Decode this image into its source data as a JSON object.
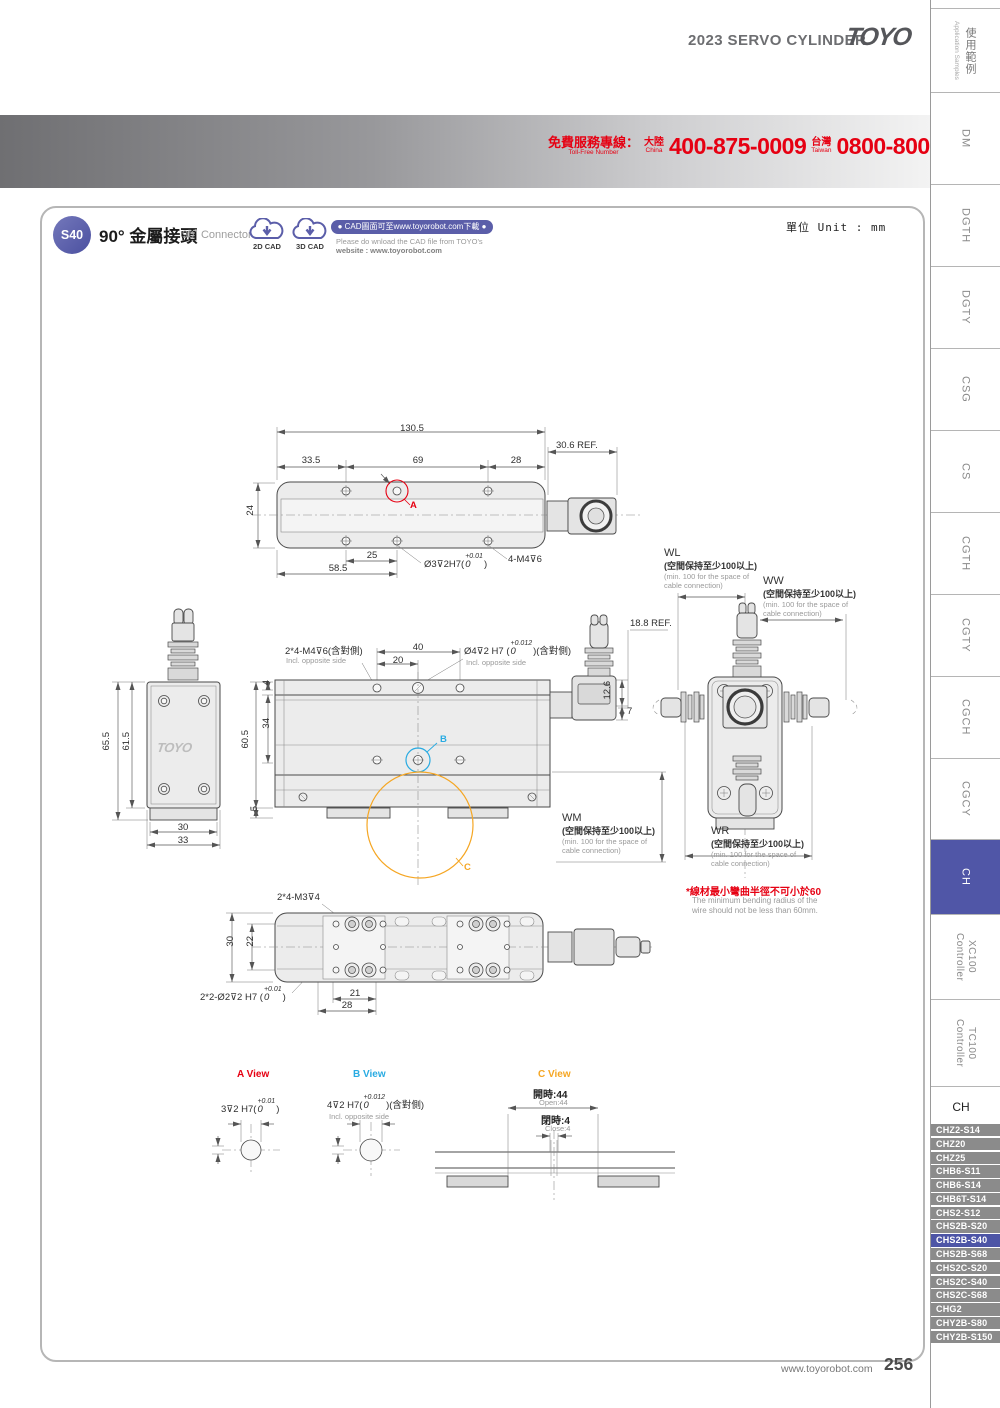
{
  "header": {
    "title": "2023 SERVO CYLINDER",
    "logo": "TOYO"
  },
  "tollfree": {
    "label_zh": "免費服務專線：",
    "label_en": "Toll-Free Number",
    "china_zh": "大陸",
    "china_en": "China",
    "china_number": "400-875-0009",
    "taiwan_zh": "台灣",
    "taiwan_en": "Taiwan",
    "taiwan_number": "0800-800-893"
  },
  "product": {
    "badge": "S40",
    "title_zh": "90° 金屬接頭",
    "title_en": "90˚ Connector",
    "cad_2d": "2D CAD",
    "cad_3d": "3D CAD",
    "cad_pill": "● CAD圖面可至www.toyorobot.com下載 ●",
    "cad_note1": "Please do wnload the CAD file from TOYO's",
    "cad_note2": "website : www.toyorobot.com",
    "unit": "單位 Unit : mm"
  },
  "sidebar": {
    "top_zh": "使用範例",
    "top_en": "Application Samples",
    "tabs": [
      "DM",
      "DGTH",
      "DGTY",
      "CSG",
      "CS",
      "CGTH",
      "CGTY",
      "CGCH",
      "CGCY"
    ],
    "active_tab": "CH",
    "controllers": [
      {
        "name": "XC100",
        "type": "Controller"
      },
      {
        "name": "TC100",
        "type": "Controller"
      }
    ]
  },
  "models": {
    "header": "CH",
    "items": [
      "CHZ2-S14",
      "CHZ20",
      "CHZ25",
      "CHB6-S11",
      "CHB6-S14",
      "CHB6T-S14",
      "CHS2-S12",
      "CHS2B-S20",
      "CHS2B-S40",
      "CHS2B-S68",
      "CHS2C-S20",
      "CHS2C-S40",
      "CHS2C-S68",
      "CHG2",
      "CHY2B-S80",
      "CHY2B-S150"
    ],
    "active_item": "CHS2B-S40"
  },
  "top_view": {
    "marker": "A",
    "dims": {
      "length": "130.5",
      "ref": "30.6 REF.",
      "left": "33.5",
      "mid": "69",
      "right": "28",
      "height": "24",
      "hole_pitch": "25",
      "hole_from_end": "58.5"
    },
    "hole": {
      "prefix": "Ø3⊽2H7(",
      "tol": "+0.01",
      "zero": "0",
      "suffix": ")"
    },
    "thread": "4-M4⊽6"
  },
  "side_view": {
    "logo": "TOYO",
    "dims": {
      "total_h": "65.5",
      "body_h": "61.5",
      "base_w": "30",
      "total_w": "33"
    }
  },
  "front_view": {
    "marker_b": "B",
    "marker_c": "C",
    "thread_note": "2*4-M4⊽6(含對側)",
    "incl_en": "Incl. opposite side",
    "hole": {
      "prefix": "Ø4⊽2 H7 (",
      "tol": "+0.012",
      "zero": "0",
      "suffix": ")(含對側)"
    },
    "hole_incl_en": "Incl. opposite side",
    "dims": {
      "pitch40": "40",
      "pitch20": "20",
      "ref": "18.8 REF.",
      "d126": "12.6",
      "d7": "7",
      "d4": "4",
      "d34": "34",
      "d605": "60.5",
      "d5": "5"
    }
  },
  "spaces": {
    "wl": {
      "code": "WL",
      "zh": "(空間保持至少100以上)",
      "en": "(min. 100 for the space of cable connection)"
    },
    "ww": {
      "code": "WW",
      "zh": "(空間保持至少100以上)",
      "en": "(min. 100 for the space of cable connection)"
    },
    "wm": {
      "code": "WM",
      "zh": "(空間保持至少100以上)",
      "en": "(min. 100 for the space of cable connection)"
    },
    "wr": {
      "code": "WR",
      "zh": "(空間保持至少100以上)",
      "en": "(min. 100 for the space of cable connection)"
    }
  },
  "bend_note": {
    "zh": "*線材最小彎曲半徑不可小於60",
    "en": "The minimum bending radius of the wire should not be less than 60mm."
  },
  "bottom_view": {
    "thread_note": "2*4-M3⊽4",
    "hole": {
      "prefix": "2*2-Ø2⊽2 H7 (",
      "tol": "+0.01",
      "zero": "0",
      "suffix": ")"
    },
    "dims": {
      "d30": "30",
      "d22": "22",
      "d21": "21",
      "d28": "28"
    }
  },
  "detail_views": {
    "a": {
      "title": "A View",
      "hole": {
        "prefix": "3⊽2 H7(",
        "tol": "+0.01",
        "zero": "0",
        "suffix": ")"
      }
    },
    "b": {
      "title": "B View",
      "hole": {
        "prefix": "4⊽2 H7(",
        "tol": "+0.012",
        "zero": "0",
        "suffix": ")(含對側)"
      },
      "incl_en": "Incl. opposite side"
    },
    "c": {
      "title": "C View",
      "open_zh": "開時:44",
      "open_en": "Open:44",
      "close_zh": "閉時:4",
      "close_en": "Close:4"
    }
  },
  "footer": {
    "site": "www.toyorobot.com",
    "page": "256"
  },
  "colors": {
    "accent_red": "#e60012",
    "accent_cyan": "#29abe2",
    "accent_orange": "#f5a623",
    "brand_purple": "#5b5ea9",
    "tab_active": "#5056a7"
  }
}
